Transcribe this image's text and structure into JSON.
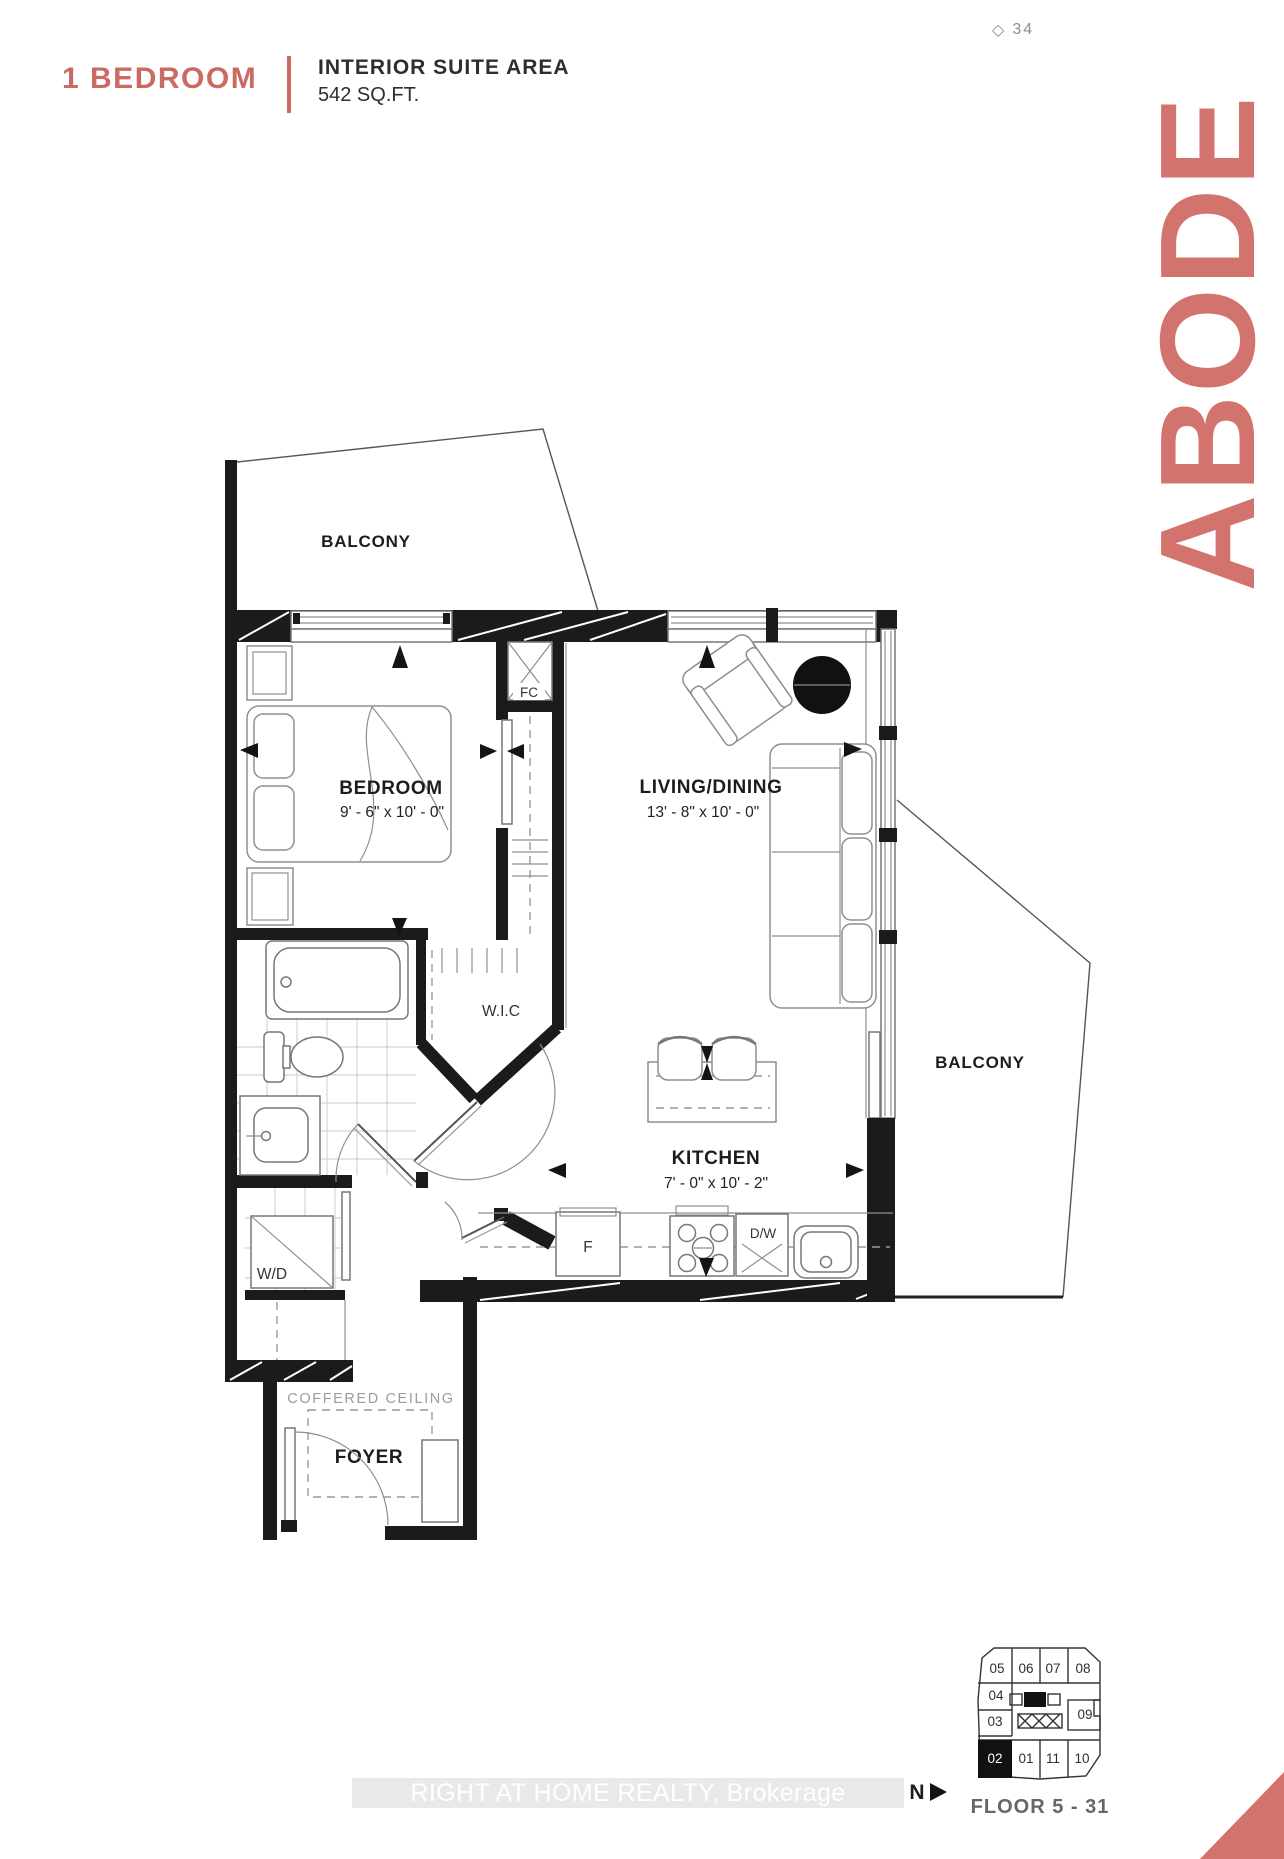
{
  "page": {
    "corner_mark": "◇",
    "page_number": "34"
  },
  "header": {
    "unit_type": "1 BEDROOM",
    "area_label": "INTERIOR SUITE AREA",
    "area_value": "542 SQ.FT."
  },
  "brand": {
    "wordmark": "ABODE"
  },
  "colors": {
    "accent_header": "#c96b63",
    "accent_brand": "#d3736d",
    "wall_black": "#1b1b1b",
    "watermark_band": "#e9e9e9"
  },
  "plan": {
    "balcony_top": {
      "label": "BALCONY"
    },
    "balcony_right": {
      "label": "BALCONY"
    },
    "bedroom": {
      "label": "BEDROOM",
      "dims": "9' - 6\" x 10' - 0\""
    },
    "living_dining": {
      "label": "LIVING/DINING",
      "dims": "13' - 8\" x 10' - 0\""
    },
    "kitchen": {
      "label": "KITCHEN",
      "dims": "7' - 0\" x 10' - 2\""
    },
    "wic": {
      "label": "W.I.C"
    },
    "foyer": {
      "label": "FOYER"
    },
    "coffered_ceiling": {
      "label": "COFFERED CEILING"
    },
    "fan_coil": {
      "label": "FC"
    },
    "washer_dryer": {
      "label": "W/D"
    },
    "fridge": {
      "label": "F"
    },
    "dishwasher": {
      "label": "D/W"
    }
  },
  "keyplate": {
    "floor_label": "FLOOR 5 - 31",
    "highlighted_unit": "02",
    "units": {
      "u05": "05",
      "u06": "06",
      "u07": "07",
      "u08": "08",
      "u04": "04",
      "u03": "03",
      "u09": "09",
      "u02": "02",
      "u01": "01",
      "u11": "11",
      "u10": "10"
    }
  },
  "compass": {
    "label": "N"
  },
  "watermark": {
    "text": "RIGHT AT HOME REALTY, Brokerage"
  }
}
